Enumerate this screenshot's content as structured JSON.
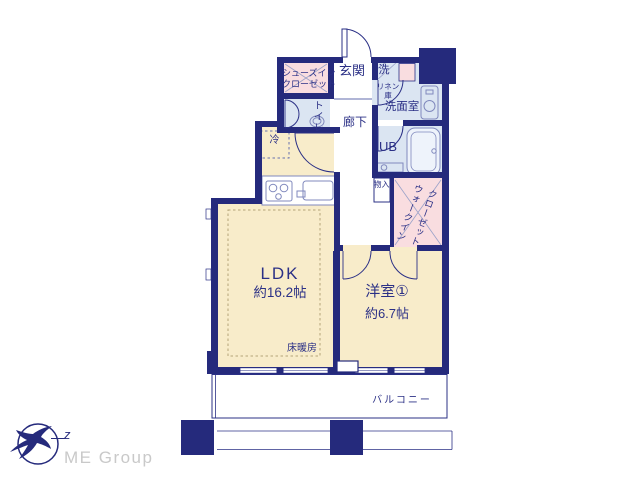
{
  "branding": {
    "company": "ME Group",
    "logo_letter": "z"
  },
  "floorplan": {
    "rooms": {
      "ldk": {
        "label": "LDK",
        "size": "約16.2帖"
      },
      "western_room_1": {
        "label": "洋室①",
        "size": "約6.7帖"
      },
      "entrance": {
        "label": "玄関"
      },
      "corridor": {
        "label": "廊下"
      },
      "toilet": {
        "label": "トイレ"
      },
      "shoe_closet": {
        "label_line1": "シューズイン",
        "label_line2": "クローゼット"
      },
      "laundry": {
        "label": "洗"
      },
      "linen_cabinet": {
        "label_line1": "リネン",
        "label_line2": "庫"
      },
      "washroom": {
        "label": "洗面室"
      },
      "unit_bath": {
        "label": "UB"
      },
      "storage": {
        "label": "物入"
      },
      "walk_in_closet": {
        "label_line1": "ウォークイン",
        "label_line2": "クローゼット"
      },
      "refrigerator": {
        "label": "冷"
      },
      "floor_heating": {
        "label": "床暖房"
      },
      "balcony": {
        "label": "バルコニー"
      }
    },
    "colors": {
      "wall": "#252a7c",
      "room_floor": "#f8ecca",
      "closet_floor": "#f9dde0",
      "wet_area_floor": "#dbe5f2",
      "label_text": "#2b3086",
      "fixture_line": "#8089bd",
      "logo_text": "#c9c9c9"
    }
  }
}
